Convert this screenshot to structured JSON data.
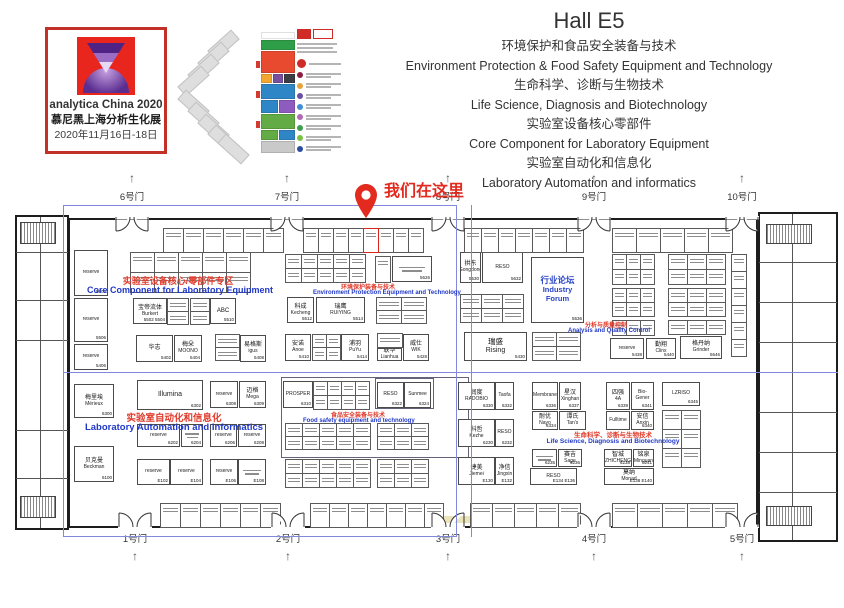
{
  "logo": {
    "line1": "analytica China 2020",
    "line2": "慕尼黑上海分析生化展",
    "line3": "2020年11月16日-18日"
  },
  "title": {
    "hall": "Hall E5",
    "lines": [
      "环境保护和食品安全装备与技术",
      "Environment Protection  & Food Safety Equipment and Technology",
      "生命科学、诊断与生物技术",
      "Life Science, Diagnosis and Biotechnology",
      "实验室设备核心零部件",
      "Core Component for Laboratory Equipment",
      "实验室自动化和信息化",
      "Laboratory Automation and informatics"
    ]
  },
  "marker": {
    "label": "我们在这里",
    "color": "#e22a1e"
  },
  "minimap": {
    "stack": [
      {
        "h": 7,
        "colors": [
          "#ffffff"
        ]
      },
      {
        "h": 10,
        "colors": [
          "#2f9e49"
        ]
      },
      {
        "h": 22,
        "colors": [
          "#e84a2f"
        ]
      },
      {
        "h": 9,
        "colors": [
          "#f2a72e",
          "#7a4fa0",
          "#3c3c44"
        ]
      },
      {
        "h": 15,
        "colors": [
          "#2f86c6"
        ]
      },
      {
        "h": 13,
        "colors": [
          "#2f86c6",
          "#8e5bbf"
        ]
      },
      {
        "h": 15,
        "colors": [
          "#63ab44"
        ]
      },
      {
        "h": 10,
        "colors": [
          "#63ab44",
          "#2f86c6"
        ]
      },
      {
        "h": 12,
        "colors": [
          "#c9c9c9"
        ]
      }
    ],
    "legend_dots": [
      "#8c1d40",
      "#e8a23d",
      "#6a4fa3",
      "#3f8fd2",
      "#b06ab3",
      "#3f9e4d",
      "#7ac143",
      "#2b4ea0"
    ],
    "header_color": "#cf2b27"
  },
  "plan": {
    "arrow": "↑",
    "gates": {
      "top": [
        {
          "label": "6号门",
          "x": 132
        },
        {
          "label": "7号门",
          "x": 287
        },
        {
          "label": "8号门",
          "x": 448
        },
        {
          "label": "9号门",
          "x": 594
        },
        {
          "label": "10号门",
          "x": 742
        }
      ],
      "bottom": [
        {
          "label": "1号门",
          "x": 135
        },
        {
          "label": "2号门",
          "x": 288
        },
        {
          "label": "3号门",
          "x": 448
        },
        {
          "label": "4号门",
          "x": 594
        },
        {
          "label": "5号门",
          "x": 742
        }
      ]
    },
    "zone_labels": [
      {
        "cn": "实验室设备核心/零部件专区",
        "en": "Core Component for Laboratory Equipment",
        "cb": [
          108,
          274,
          140,
          9
        ],
        "eb": [
          85,
          285,
          190,
          9
        ]
      },
      {
        "cn": "环境保护装备与技术",
        "en": "Environment Protection Equipment and Technology",
        "cb": [
          340,
          282,
          56,
          6
        ],
        "eb": [
          313,
          290,
          144,
          6
        ]
      },
      {
        "cn": "分析与质量控制",
        "en": "Analysis and Quality Control",
        "cb": [
          584,
          320,
          44,
          6
        ],
        "eb": [
          568,
          328,
          78,
          6
        ]
      },
      {
        "cn": "实验室自动化和信息化",
        "en": "Laboratory Automation and Informatics",
        "cb": [
          122,
          410,
          104,
          9.5
        ],
        "eb": [
          76,
          422,
          196,
          9.5
        ]
      },
      {
        "cn": "食品安全装备与技术",
        "en": "Food safety equipment and technology",
        "cb": [
          330,
          410,
          56,
          6
        ],
        "eb": [
          303,
          418,
          110,
          6
        ]
      },
      {
        "cn": "生命科学、诊断与生物技术",
        "en": "Life Science, Diagnosis and Biotechnology",
        "cb": [
          573,
          429,
          80,
          6.5
        ],
        "eb": [
          546,
          438,
          134,
          6.5
        ]
      }
    ],
    "booths": [
      {
        "en": "reserve",
        "num": "5606",
        "x": 74,
        "y": 250,
        "w": 34,
        "h": 46
      },
      {
        "en": "reserve",
        "num": "5506",
        "x": 74,
        "y": 298,
        "w": 34,
        "h": 44
      },
      {
        "en": "reserve",
        "num": "5406",
        "x": 74,
        "y": 344,
        "w": 34,
        "h": 26
      },
      {
        "cn": "宝帝流体",
        "en": "Burkert",
        "num": "5502 5504",
        "x": 133,
        "y": 298,
        "w": 34,
        "h": 26
      },
      {
        "cn": "ABC",
        "num": "5510",
        "x": 210,
        "y": 298,
        "w": 26,
        "h": 26
      },
      {
        "cn": "华志",
        "num": "5402",
        "x": 136,
        "y": 335,
        "w": 37,
        "h": 27
      },
      {
        "cn": "梅朵",
        "en": "MOONO",
        "num": "5404",
        "x": 174,
        "y": 335,
        "w": 28,
        "h": 27
      },
      {
        "cn": "易格斯",
        "en": "igus",
        "num": "5408",
        "x": 240,
        "y": 335,
        "w": 26,
        "h": 27
      },
      {
        "num": "5626",
        "x": 392,
        "y": 256,
        "w": 40,
        "h": 26,
        "sq": true
      },
      {
        "cn": "科成",
        "en": "Kecheng",
        "num": "5512",
        "x": 287,
        "y": 297,
        "w": 27,
        "h": 26
      },
      {
        "cn": "瑞鹰",
        "en": "RUIYING",
        "num": "5514",
        "x": 316,
        "y": 297,
        "w": 49,
        "h": 26
      },
      {
        "cn": "安诺",
        "en": "Anoe",
        "num": "5410",
        "x": 285,
        "y": 334,
        "w": 26,
        "h": 27
      },
      {
        "cn": "浦羽",
        "en": "PuYu",
        "num": "5414",
        "x": 341,
        "y": 334,
        "w": 28,
        "h": 27
      },
      {
        "cn": "联华",
        "en": "Lianhua",
        "x": 377,
        "y": 348,
        "w": 25,
        "h": 13
      },
      {
        "cn": "威仕",
        "en": "WIK",
        "num": "5428",
        "x": 403,
        "y": 334,
        "w": 26,
        "h": 27
      },
      {
        "cn": "拱东",
        "en": "Gongdong",
        "num": "5630",
        "x": 460,
        "y": 252,
        "w": 21,
        "h": 31
      },
      {
        "en": "RESO",
        "num": "5632",
        "x": 482,
        "y": 252,
        "w": 41,
        "h": 31
      },
      {
        "cn": "行业论坛",
        "en": "Industry Forum",
        "num": "5536",
        "x": 531,
        "y": 257,
        "w": 53,
        "h": 66,
        "forum": true
      },
      {
        "cn": "瑞盛",
        "en": "Rising",
        "num": "5430",
        "x": 464,
        "y": 332,
        "w": 63,
        "h": 29,
        "big": true
      },
      {
        "en": "reserve",
        "num": "5438",
        "x": 610,
        "y": 338,
        "w": 34,
        "h": 21
      },
      {
        "cn": "勤翔",
        "en": "Clinx",
        "num": "5440",
        "x": 646,
        "y": 338,
        "w": 30,
        "h": 21
      },
      {
        "cn": "格丹纳",
        "en": "Grinder",
        "num": "5646",
        "x": 680,
        "y": 336,
        "w": 42,
        "h": 23
      },
      {
        "cn": "梅里埃",
        "en": "Mérieux",
        "num": "6300",
        "x": 74,
        "y": 384,
        "w": 40,
        "h": 34
      },
      {
        "cn": "贝克曼",
        "en": "Beckman",
        "num": "6100",
        "x": 74,
        "y": 446,
        "w": 40,
        "h": 36
      },
      {
        "en": "Illumina",
        "num": "6302",
        "x": 137,
        "y": 380,
        "w": 66,
        "h": 30,
        "big": true
      },
      {
        "en": "reserve",
        "num": "6308",
        "x": 210,
        "y": 381,
        "w": 28,
        "h": 27
      },
      {
        "cn": "迈格",
        "en": "Mega",
        "num": "6309",
        "x": 239,
        "y": 381,
        "w": 27,
        "h": 27
      },
      {
        "en": "reserve",
        "num": "6202",
        "x": 137,
        "y": 424,
        "w": 43,
        "h": 23
      },
      {
        "num": "6204",
        "x": 181,
        "y": 424,
        "w": 22,
        "h": 23,
        "sq": true
      },
      {
        "en": "reserve",
        "num": "6206",
        "x": 210,
        "y": 424,
        "w": 27,
        "h": 23
      },
      {
        "en": "reserve",
        "num": "6208",
        "x": 238,
        "y": 424,
        "w": 28,
        "h": 23
      },
      {
        "en": "reserve",
        "num": "E102",
        "x": 137,
        "y": 459,
        "w": 33,
        "h": 26
      },
      {
        "en": "reserve",
        "num": "E104",
        "x": 170,
        "y": 459,
        "w": 33,
        "h": 26
      },
      {
        "en": "reserve",
        "num": "E106",
        "x": 210,
        "y": 459,
        "w": 28,
        "h": 26
      },
      {
        "num": "E108",
        "x": 238,
        "y": 459,
        "w": 28,
        "h": 26,
        "sq": true
      },
      {
        "en": "PROSPER",
        "num": "6310",
        "x": 283,
        "y": 381,
        "w": 30,
        "h": 27
      },
      {
        "en": "RESO",
        "num": "6322",
        "x": 377,
        "y": 382,
        "w": 27,
        "h": 26
      },
      {
        "en": "Sunmee",
        "num": "6324",
        "x": 404,
        "y": 382,
        "w": 27,
        "h": 26
      },
      {
        "cn": "润度",
        "en": "RADOBIO",
        "num": "6330",
        "x": 458,
        "y": 382,
        "w": 37,
        "h": 28
      },
      {
        "en": "Taofa",
        "num": "6332",
        "x": 495,
        "y": 382,
        "w": 19,
        "h": 28
      },
      {
        "cn": "科哲",
        "en": "Kezhe",
        "num": "6230",
        "x": 458,
        "y": 419,
        "w": 37,
        "h": 28
      },
      {
        "en": "RESO",
        "num": "6232",
        "x": 495,
        "y": 419,
        "w": 19,
        "h": 28
      },
      {
        "cn": "捷美",
        "en": "Jiemei",
        "num": "E130",
        "x": 458,
        "y": 457,
        "w": 37,
        "h": 28
      },
      {
        "cn": "净信",
        "en": "Jingxin",
        "num": "E132",
        "x": 495,
        "y": 457,
        "w": 19,
        "h": 28
      },
      {
        "en": "Membrane",
        "num": "6336",
        "x": 532,
        "y": 382,
        "w": 26,
        "h": 28
      },
      {
        "cn": "星汉",
        "en": "Xinghan",
        "num": "6337",
        "x": 559,
        "y": 382,
        "w": 22,
        "h": 28
      },
      {
        "cn": "耐优",
        "en": "Nayo",
        "num": "6334",
        "x": 532,
        "y": 411,
        "w": 26,
        "h": 19
      },
      {
        "cn": "谭氏",
        "en": "Tan's",
        "x": 559,
        "y": 411,
        "w": 27,
        "h": 19
      },
      {
        "num": "6235",
        "x": 532,
        "y": 449,
        "w": 25,
        "h": 18,
        "sq": true
      },
      {
        "cn": "赛吉",
        "en": "Sage",
        "num": "6236",
        "x": 558,
        "y": 449,
        "w": 24,
        "h": 18
      },
      {
        "en": "RESO",
        "num": "E134 E136",
        "x": 530,
        "y": 468,
        "w": 47,
        "h": 17
      },
      {
        "cn": "四强",
        "en": "4A",
        "num": "6339",
        "x": 606,
        "y": 382,
        "w": 24,
        "h": 28
      },
      {
        "en": "Bio-Gener",
        "num": "6341",
        "x": 631,
        "y": 382,
        "w": 23,
        "h": 28
      },
      {
        "en": "Fulltime",
        "x": 606,
        "y": 411,
        "w": 24,
        "h": 19
      },
      {
        "cn": "安信",
        "en": "Anxin",
        "num": "6340",
        "x": 631,
        "y": 411,
        "w": 23,
        "h": 19
      },
      {
        "cn": "智城",
        "en": "ZHICHENG",
        "num": "6238",
        "x": 604,
        "y": 449,
        "w": 28,
        "h": 18
      },
      {
        "cn": "铭泉",
        "en": "Minquan",
        "num": "6241",
        "x": 633,
        "y": 449,
        "w": 21,
        "h": 18
      },
      {
        "cn": "莫纳",
        "en": "Monad",
        "num": "E138 E140",
        "x": 604,
        "y": 468,
        "w": 50,
        "h": 17
      },
      {
        "en": "LZRISO",
        "num": "6345",
        "x": 662,
        "y": 382,
        "w": 38,
        "h": 24
      }
    ],
    "grids": [
      {
        "x": 130,
        "y": 252,
        "cols": 5,
        "rows": 2,
        "cw": 24,
        "ch": 20
      },
      {
        "x": 285,
        "y": 254,
        "cols": 5,
        "rows": 2,
        "cw": 16,
        "ch": 14
      },
      {
        "x": 375,
        "y": 256,
        "cols": 1,
        "rows": 1,
        "cw": 15,
        "ch": 26
      },
      {
        "x": 167,
        "y": 298,
        "cols": 1,
        "rows": 2,
        "cw": 21,
        "ch": 13
      },
      {
        "x": 190,
        "y": 298,
        "cols": 1,
        "rows": 2,
        "cw": 19,
        "ch": 13
      },
      {
        "x": 376,
        "y": 297,
        "cols": 2,
        "rows": 2,
        "cw": 25,
        "ch": 13
      },
      {
        "x": 312,
        "y": 334,
        "cols": 2,
        "rows": 2,
        "cw": 14,
        "ch": 13
      },
      {
        "x": 377,
        "y": 333,
        "cols": 1,
        "rows": 1,
        "cw": 25,
        "ch": 14
      },
      {
        "x": 215,
        "y": 334,
        "cols": 1,
        "rows": 2,
        "cw": 24,
        "ch": 13
      },
      {
        "x": 460,
        "y": 294,
        "cols": 3,
        "rows": 2,
        "cw": 21,
        "ch": 14
      },
      {
        "x": 532,
        "y": 332,
        "cols": 2,
        "rows": 2,
        "cw": 24,
        "ch": 14
      },
      {
        "x": 612,
        "y": 254,
        "cols": 3,
        "rows": 2,
        "cw": 14,
        "ch": 15
      },
      {
        "x": 668,
        "y": 254,
        "cols": 3,
        "rows": 2,
        "cw": 19,
        "ch": 15
      },
      {
        "x": 612,
        "y": 288,
        "cols": 3,
        "rows": 2,
        "cw": 14,
        "ch": 14
      },
      {
        "x": 668,
        "y": 288,
        "cols": 3,
        "rows": 2,
        "cw": 19,
        "ch": 14
      },
      {
        "x": 612,
        "y": 320,
        "cols": 3,
        "rows": 1,
        "cw": 14,
        "ch": 15
      },
      {
        "x": 668,
        "y": 320,
        "cols": 3,
        "rows": 1,
        "cw": 19,
        "ch": 14
      },
      {
        "x": 731,
        "y": 254,
        "cols": 1,
        "rows": 6,
        "cw": 15,
        "ch": 17
      },
      {
        "x": 313,
        "y": 381,
        "cols": 2,
        "rows": 2,
        "cw": 14,
        "ch": 14
      },
      {
        "x": 341,
        "y": 381,
        "cols": 2,
        "rows": 2,
        "cw": 14,
        "ch": 14
      },
      {
        "x": 285,
        "y": 423,
        "cols": 5,
        "rows": 2,
        "cw": 17,
        "ch": 13
      },
      {
        "x": 377,
        "y": 423,
        "cols": 3,
        "rows": 2,
        "cw": 17,
        "ch": 13
      },
      {
        "x": 285,
        "y": 459,
        "cols": 5,
        "rows": 2,
        "cw": 17,
        "ch": 14
      },
      {
        "x": 377,
        "y": 459,
        "cols": 3,
        "rows": 2,
        "cw": 17,
        "ch": 14
      },
      {
        "x": 662,
        "y": 410,
        "cols": 2,
        "rows": 3,
        "cw": 19,
        "ch": 19
      },
      {
        "x": 163,
        "y": 228,
        "cols": 6,
        "rows": 1,
        "cw": 20,
        "ch": 24
      },
      {
        "x": 303,
        "y": 228,
        "cols": 8,
        "rows": 1,
        "cw": 15,
        "ch": 24,
        "hl": 4
      },
      {
        "x": 464,
        "y": 228,
        "cols": 7,
        "rows": 1,
        "cw": 17,
        "ch": 24
      },
      {
        "x": 612,
        "y": 228,
        "cols": 5,
        "rows": 1,
        "cw": 24,
        "ch": 24
      },
      {
        "x": 160,
        "y": 503,
        "cols": 6,
        "rows": 1,
        "cw": 20,
        "ch": 24
      },
      {
        "x": 310,
        "y": 503,
        "cols": 7,
        "rows": 1,
        "cw": 19,
        "ch": 24
      },
      {
        "x": 470,
        "y": 503,
        "cols": 5,
        "rows": 1,
        "cw": 22,
        "ch": 24
      },
      {
        "x": 612,
        "y": 503,
        "cols": 5,
        "rows": 1,
        "cw": 25,
        "ch": 24
      }
    ]
  }
}
